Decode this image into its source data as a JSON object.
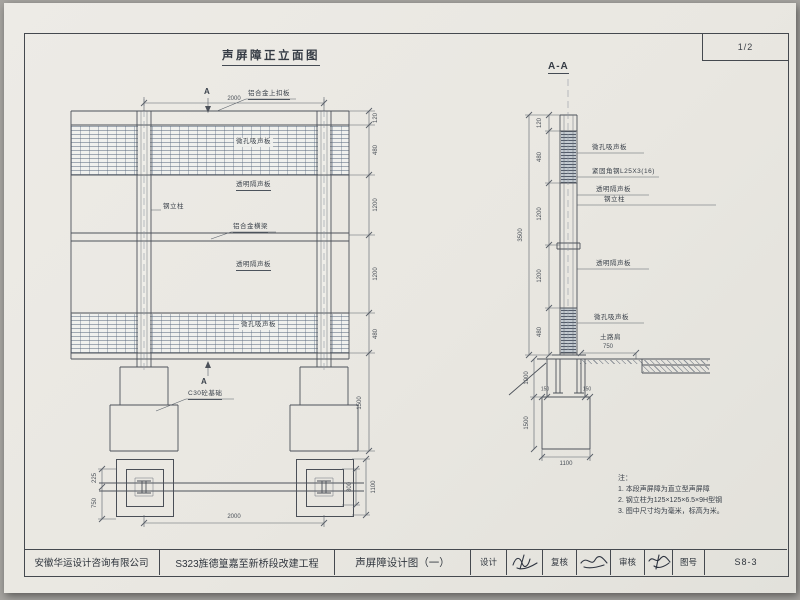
{
  "sheet": {
    "page_number": "1/2"
  },
  "elevation": {
    "title": "声屏障正立面图",
    "section_marker": "A",
    "labels": {
      "top_cap": "铝合金上扣板",
      "absorber_top": "微孔吸声板",
      "transparent_upper": "透明隔声板",
      "column": "钢立柱",
      "beam": "铝合金横梁",
      "transparent_lower": "透明隔声板",
      "absorber_bottom": "微孔吸声板",
      "foundation": "C30砼基础"
    },
    "dims": {
      "span": "2000",
      "chain": [
        "120",
        "480",
        "1200",
        "1200",
        "480"
      ],
      "foundation_depth": "1500",
      "plan_span": "2000",
      "plan_offset_front": "225",
      "plan_offset_back": "750",
      "plan_inner": "800",
      "plan_outer": "1100"
    }
  },
  "section": {
    "title": "A-A",
    "labels": {
      "absorber_top": "微孔吸声板",
      "angle_steel": "紧固角钢L25X3(16)",
      "transparent_upper": "透明隔声板",
      "column": "钢立柱",
      "transparent_lower": "透明隔声板",
      "absorber_bottom": "微孔吸声板",
      "shoulder": "土路肩"
    },
    "dims": {
      "chain": [
        "120",
        "480",
        "1200",
        "1200",
        "480"
      ],
      "overall": "3500",
      "shoulder_width": "750",
      "embed_depth": "1000",
      "foundation_height": "1500",
      "foundation_width": "1100",
      "step_left": "150",
      "step_right": "150"
    }
  },
  "notes": {
    "heading": "注：",
    "items": [
      "1. 本段声屏障为直立型声屏障",
      "2. 钢立柱为125×125×6.5×9H型钢",
      "3. 图中尺寸均为毫米，标高为米。"
    ]
  },
  "titleblock": {
    "company": "安徽华运设计咨询有限公司",
    "project": "S323旌德篁嘉至新桥段改建工程",
    "drawing_title": "声屏障设计图（一）",
    "design_label": "设计",
    "check_label": "复核",
    "audit_label": "审核",
    "number_label": "图号",
    "drawing_number": "S8-3"
  }
}
